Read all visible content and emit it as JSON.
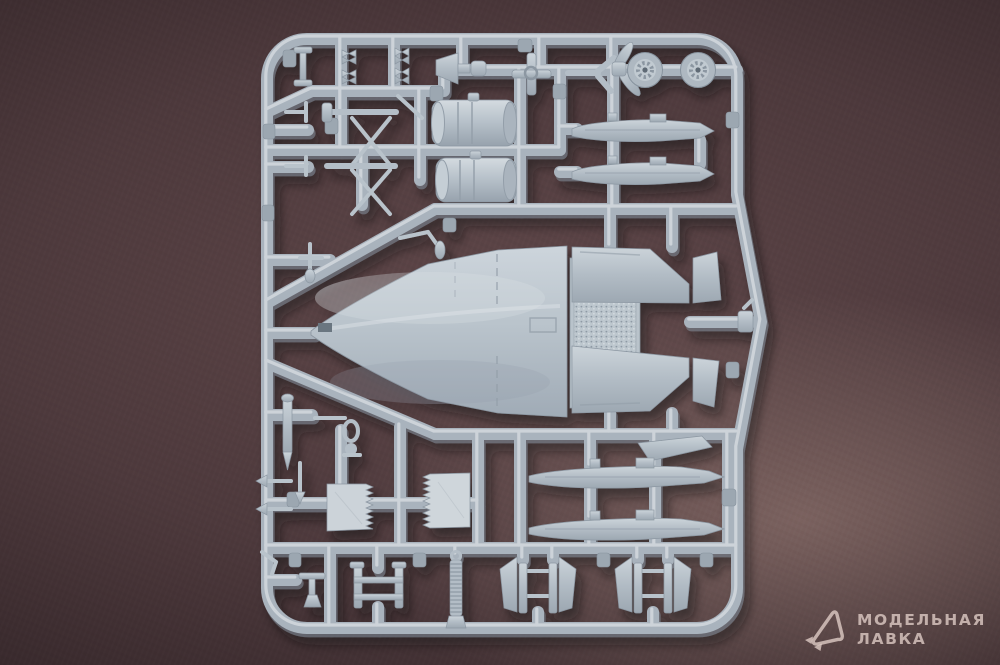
{
  "meta": {
    "type": "photograph",
    "subject": "Injection-moulded light grey plastic model aircraft sprue photographed on a dark mauve-brown surface",
    "orientation": "large upper-fuselage part in the centre, nose pointing left"
  },
  "palette": {
    "background_mid": "#543e40",
    "background_corner": "#1c1315",
    "background_highlight": "#8e7a77",
    "plastic_base": "#aab4be",
    "plastic_light": "#d6dce1",
    "plastic_dark": "#8c97a2"
  },
  "watermark": {
    "line1": "МОДЕЛЬНАЯ",
    "line2": "ЛАВКА",
    "icon": "paper-plane-logo",
    "color": "#e2cec8"
  },
  "sprue": {
    "material": "light blue-grey styrene",
    "parts": [
      {
        "id": "upper-fuselage",
        "label": "upper fuselage half"
      },
      {
        "id": "mid-connector",
        "label": "textured fuselage centre section"
      },
      {
        "id": "rear-deck-upper",
        "label": "rear fuselage wing root (upper)"
      },
      {
        "id": "rear-deck-lower",
        "label": "rear fuselage wing root (lower)"
      },
      {
        "id": "engine-can-1",
        "label": "engine section cylinder"
      },
      {
        "id": "engine-can-2",
        "label": "engine section cylinder"
      },
      {
        "id": "wheel-1",
        "label": "main wheel"
      },
      {
        "id": "wheel-2",
        "label": "main wheel"
      },
      {
        "id": "tank-half-1",
        "label": "drop tank half"
      },
      {
        "id": "tank-half-2",
        "label": "drop tank half"
      },
      {
        "id": "tank-half-3",
        "label": "drop tank half"
      },
      {
        "id": "tank-half-4",
        "label": "drop tank half"
      },
      {
        "id": "intake-cone",
        "label": "intake cone"
      },
      {
        "id": "control-cross",
        "label": "control column cross"
      },
      {
        "id": "gear-strut-assembly",
        "label": "landing gear strut and braces"
      },
      {
        "id": "speedbrake-panel-1",
        "label": "serrated speed-brake panel"
      },
      {
        "id": "speedbrake-panel-2",
        "label": "serrated speed-brake panel"
      },
      {
        "id": "corrugated-hose",
        "label": "corrugated hose"
      },
      {
        "id": "gear-door-set-1",
        "label": "landing gear door pair"
      },
      {
        "id": "gear-door-set-2",
        "label": "landing gear door pair"
      },
      {
        "id": "gear-door-frame",
        "label": "small door frame assembly"
      },
      {
        "id": "fin-tip",
        "label": "fin tip panel"
      },
      {
        "id": "small-parts",
        "label": "small pylons, probes and antennas"
      }
    ]
  }
}
